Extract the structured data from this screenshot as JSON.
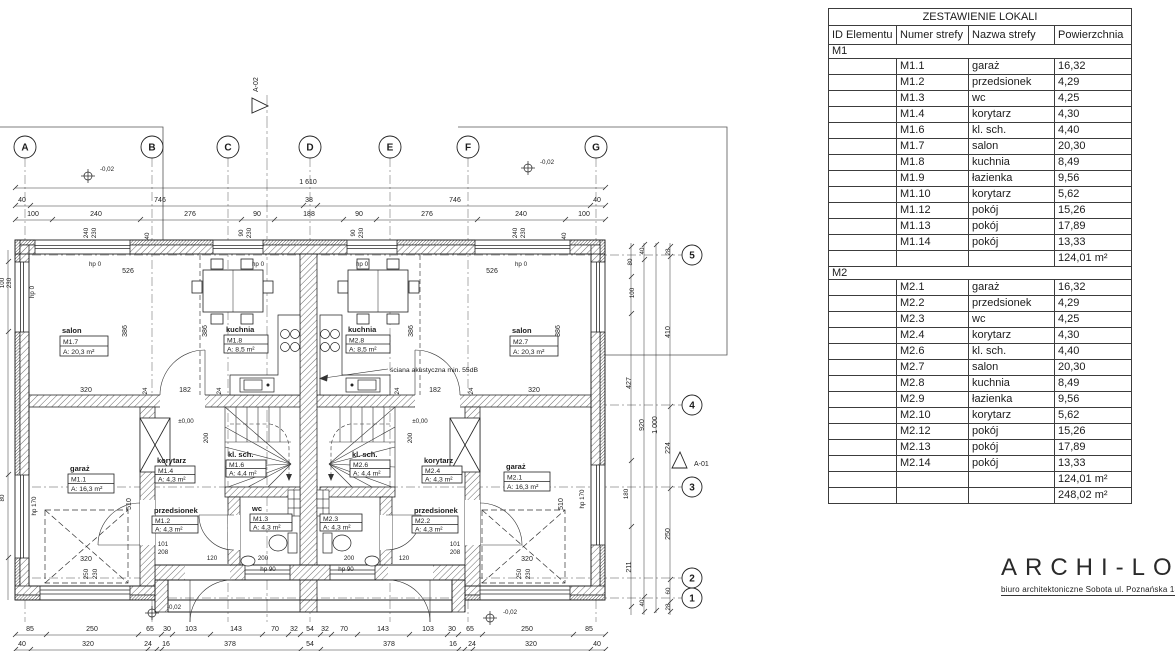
{
  "plan": {
    "grid_cols": [
      "A",
      "B",
      "C",
      "D",
      "E",
      "F",
      "G"
    ],
    "grid_rows": [
      "5",
      "4",
      "3",
      "2",
      "1"
    ],
    "section_markers": {
      "top": "A-02",
      "right": "A-01"
    },
    "rooms": {
      "m1_7": {
        "name": "salon",
        "id": "M1.7",
        "area": "A: 20,3 m²"
      },
      "m1_8": {
        "name": "kuchnia",
        "id": "M1.8",
        "area": "A: 8,5 m²"
      },
      "m2_8": {
        "name": "kuchnia",
        "id": "M2.8",
        "area": "A: 8,5 m²"
      },
      "m2_7": {
        "name": "salon",
        "id": "M2.7",
        "area": "A: 20,3 m²"
      },
      "m1_1": {
        "name": "garaż",
        "id": "M1.1",
        "area": "A: 16,3 m²"
      },
      "m1_4": {
        "name": "korytarz",
        "id": "M1.4",
        "area": "A: 4,3 m²"
      },
      "m1_6": {
        "name": "kl. sch.",
        "id": "M1.6",
        "area": "A: 4,4 m²"
      },
      "m1_2": {
        "name": "przedsionek",
        "id": "M1.2",
        "area": "A: 4,3 m²"
      },
      "m1_3": {
        "name": "wc",
        "id": "M1.3",
        "area": "A: 4,3 m²"
      },
      "m2_6": {
        "name": "kl. sch.",
        "id": "M2.6",
        "area": "A: 4,4 m²"
      },
      "m2_4": {
        "name": "korytarz",
        "id": "M2.4",
        "area": "A: 4,3 m²"
      },
      "m2_2": {
        "name": "przedsionek",
        "id": "M2.2",
        "area": "A: 4,3 m²"
      },
      "m2_3": {
        "name": "",
        "id": "M2.3",
        "area": "A: 4,3 m²"
      },
      "m2_1": {
        "name": "garaż",
        "id": "M2.1",
        "area": "A: 16,3 m²"
      }
    },
    "notes": {
      "acoustic": "ściana akustyczna min. 55dB"
    },
    "dim_labels": [
      {
        "t": "1 610",
        "x": 308,
        "y": 184
      },
      {
        "t": "40",
        "x": 22,
        "y": 202
      },
      {
        "t": "746",
        "x": 160,
        "y": 202
      },
      {
        "t": "38",
        "x": 309,
        "y": 202
      },
      {
        "t": "746",
        "x": 455,
        "y": 202
      },
      {
        "t": "40",
        "x": 597,
        "y": 202
      },
      {
        "t": "100",
        "x": 33,
        "y": 216
      },
      {
        "t": "240",
        "x": 96,
        "y": 216
      },
      {
        "t": "276",
        "x": 190,
        "y": 216
      },
      {
        "t": "90",
        "x": 257,
        "y": 216
      },
      {
        "t": "188",
        "x": 309,
        "y": 216
      },
      {
        "t": "90",
        "x": 359,
        "y": 216
      },
      {
        "t": "276",
        "x": 427,
        "y": 216
      },
      {
        "t": "240",
        "x": 521,
        "y": 216
      },
      {
        "t": "100",
        "x": 584,
        "y": 216
      },
      {
        "t": "240",
        "x": 88,
        "y": 233,
        "r": 1,
        "s": 1
      },
      {
        "t": "230",
        "x": 96,
        "y": 233,
        "r": 1,
        "s": 1
      },
      {
        "t": "40",
        "x": 149,
        "y": 236,
        "r": 1,
        "s": 1
      },
      {
        "t": "90",
        "x": 243,
        "y": 233,
        "r": 1,
        "s": 1
      },
      {
        "t": "230",
        "x": 251,
        "y": 233,
        "r": 1,
        "s": 1
      },
      {
        "t": "90",
        "x": 355,
        "y": 233,
        "r": 1,
        "s": 1
      },
      {
        "t": "230",
        "x": 363,
        "y": 233,
        "r": 1,
        "s": 1
      },
      {
        "t": "240",
        "x": 517,
        "y": 233,
        "r": 1,
        "s": 1
      },
      {
        "t": "230",
        "x": 525,
        "y": 233,
        "r": 1,
        "s": 1
      },
      {
        "t": "40",
        "x": 566,
        "y": 236,
        "r": 1,
        "s": 1
      },
      {
        "t": "-0,02",
        "x": 107,
        "y": 171,
        "s": 1
      },
      {
        "t": "-0,02",
        "x": 547,
        "y": 164,
        "s": 1
      },
      {
        "t": "hp 0",
        "x": 95,
        "y": 266,
        "s": 1
      },
      {
        "t": "hp 0",
        "x": 258,
        "y": 266,
        "s": 1
      },
      {
        "t": "hp 0",
        "x": 362,
        "y": 266,
        "s": 1
      },
      {
        "t": "hp 0",
        "x": 521,
        "y": 266,
        "s": 1
      },
      {
        "t": "526",
        "x": 128,
        "y": 273
      },
      {
        "t": "526",
        "x": 492,
        "y": 273
      },
      {
        "t": "386",
        "x": 127,
        "y": 331,
        "r": 1
      },
      {
        "t": "386",
        "x": 207,
        "y": 331,
        "r": 1
      },
      {
        "t": "386",
        "x": 413,
        "y": 331,
        "r": 1
      },
      {
        "t": "386",
        "x": 560,
        "y": 331,
        "r": 1
      },
      {
        "t": "320",
        "x": 86,
        "y": 392
      },
      {
        "t": "24",
        "x": 147,
        "y": 391,
        "r": 1,
        "s": 1
      },
      {
        "t": "182",
        "x": 185,
        "y": 392
      },
      {
        "t": "24",
        "x": 221,
        "y": 391,
        "r": 1,
        "s": 1
      },
      {
        "t": "24",
        "x": 399,
        "y": 391,
        "r": 1,
        "s": 1
      },
      {
        "t": "182",
        "x": 435,
        "y": 392
      },
      {
        "t": "24",
        "x": 473,
        "y": 391,
        "r": 1,
        "s": 1
      },
      {
        "t": "320",
        "x": 534,
        "y": 392
      },
      {
        "t": "±0,00",
        "x": 186,
        "y": 423,
        "s": 1
      },
      {
        "t": "±0,00",
        "x": 420,
        "y": 423,
        "s": 1
      },
      {
        "t": "200",
        "x": 208,
        "y": 438,
        "r": 1,
        "s": 1
      },
      {
        "t": "200",
        "x": 412,
        "y": 438,
        "r": 1,
        "s": 1
      },
      {
        "t": "510",
        "x": 131,
        "y": 504,
        "r": 1
      },
      {
        "t": "510",
        "x": 563,
        "y": 504,
        "r": 1
      },
      {
        "t": "hp 170",
        "x": 36,
        "y": 506,
        "r": 1,
        "s": 1
      },
      {
        "t": "hp 170",
        "x": 584,
        "y": 499,
        "r": 1,
        "s": 1
      },
      {
        "t": "100",
        "x": 4,
        "y": 283,
        "r": 1,
        "s": 1
      },
      {
        "t": "230",
        "x": 11,
        "y": 283,
        "r": 1,
        "s": 1
      },
      {
        "t": "hp 0",
        "x": 34,
        "y": 292,
        "r": 1,
        "s": 1
      },
      {
        "t": "80",
        "x": 4,
        "y": 498,
        "r": 1,
        "s": 1
      },
      {
        "t": "101",
        "x": 163,
        "y": 546,
        "s": 1
      },
      {
        "t": "208",
        "x": 163,
        "y": 554,
        "s": 1
      },
      {
        "t": "101",
        "x": 455,
        "y": 546,
        "s": 1
      },
      {
        "t": "208",
        "x": 455,
        "y": 554,
        "s": 1
      },
      {
        "t": "120",
        "x": 212,
        "y": 560,
        "s": 1
      },
      {
        "t": "200",
        "x": 263,
        "y": 560,
        "s": 1
      },
      {
        "t": "200",
        "x": 349,
        "y": 560,
        "s": 1
      },
      {
        "t": "120",
        "x": 404,
        "y": 560,
        "s": 1
      },
      {
        "t": "320",
        "x": 86,
        "y": 561
      },
      {
        "t": "320",
        "x": 527,
        "y": 561
      },
      {
        "t": "250",
        "x": 88,
        "y": 574,
        "r": 1,
        "s": 1
      },
      {
        "t": "230",
        "x": 97,
        "y": 574,
        "r": 1,
        "s": 1
      },
      {
        "t": "250",
        "x": 521,
        "y": 574,
        "r": 1,
        "s": 1
      },
      {
        "t": "230",
        "x": 530,
        "y": 574,
        "r": 1,
        "s": 1
      },
      {
        "t": "hp 90",
        "x": 268,
        "y": 571,
        "s": 1
      },
      {
        "t": "hp 90",
        "x": 346,
        "y": 571,
        "s": 1
      },
      {
        "t": "-0,02",
        "x": 174,
        "y": 609,
        "s": 1
      },
      {
        "t": "-0,02",
        "x": 510,
        "y": 614,
        "s": 1
      },
      {
        "t": "80",
        "x": 632,
        "y": 262,
        "r": 1,
        "s": 1
      },
      {
        "t": "100",
        "x": 634,
        "y": 293,
        "r": 1,
        "s": 1
      },
      {
        "t": "427",
        "x": 631,
        "y": 383,
        "r": 1
      },
      {
        "t": "180",
        "x": 628,
        "y": 494,
        "r": 1,
        "s": 1
      },
      {
        "t": "211",
        "x": 631,
        "y": 567,
        "r": 1
      },
      {
        "t": "40",
        "x": 644,
        "y": 251,
        "r": 1,
        "s": 1
      },
      {
        "t": "920",
        "x": 644,
        "y": 425,
        "r": 1
      },
      {
        "t": "40",
        "x": 644,
        "y": 603,
        "r": 1,
        "s": 1
      },
      {
        "t": "1 000",
        "x": 657,
        "y": 425,
        "r": 1
      },
      {
        "t": "28",
        "x": 670,
        "y": 252,
        "r": 1,
        "s": 1
      },
      {
        "t": "410",
        "x": 670,
        "y": 332,
        "r": 1
      },
      {
        "t": "224",
        "x": 670,
        "y": 448,
        "r": 1
      },
      {
        "t": "250",
        "x": 670,
        "y": 534,
        "r": 1
      },
      {
        "t": "60",
        "x": 670,
        "y": 591,
        "r": 1,
        "s": 1
      },
      {
        "t": "28",
        "x": 670,
        "y": 607,
        "r": 1,
        "s": 1
      },
      {
        "t": "85",
        "x": 30,
        "y": 631
      },
      {
        "t": "250",
        "x": 92,
        "y": 631
      },
      {
        "t": "65",
        "x": 150,
        "y": 631
      },
      {
        "t": "30",
        "x": 167,
        "y": 631
      },
      {
        "t": "103",
        "x": 191,
        "y": 631
      },
      {
        "t": "143",
        "x": 236,
        "y": 631
      },
      {
        "t": "70",
        "x": 275,
        "y": 631
      },
      {
        "t": "32",
        "x": 294,
        "y": 631
      },
      {
        "t": "54",
        "x": 310,
        "y": 631
      },
      {
        "t": "32",
        "x": 325,
        "y": 631
      },
      {
        "t": "70",
        "x": 344,
        "y": 631
      },
      {
        "t": "143",
        "x": 383,
        "y": 631
      },
      {
        "t": "103",
        "x": 428,
        "y": 631
      },
      {
        "t": "30",
        "x": 452,
        "y": 631
      },
      {
        "t": "65",
        "x": 470,
        "y": 631
      },
      {
        "t": "250",
        "x": 527,
        "y": 631
      },
      {
        "t": "85",
        "x": 589,
        "y": 631
      },
      {
        "t": "40",
        "x": 22,
        "y": 646
      },
      {
        "t": "320",
        "x": 88,
        "y": 646
      },
      {
        "t": "24",
        "x": 148,
        "y": 646
      },
      {
        "t": "16",
        "x": 166,
        "y": 646
      },
      {
        "t": "378",
        "x": 230,
        "y": 646
      },
      {
        "t": "54",
        "x": 310,
        "y": 646
      },
      {
        "t": "378",
        "x": 389,
        "y": 646
      },
      {
        "t": "16",
        "x": 453,
        "y": 646
      },
      {
        "t": "24",
        "x": 472,
        "y": 646
      },
      {
        "t": "320",
        "x": 531,
        "y": 646
      },
      {
        "t": "40",
        "x": 597,
        "y": 646
      }
    ]
  },
  "table": {
    "title": "ZESTAWIENIE LOKALI",
    "columns": [
      "ID Elementu",
      "Numer strefy",
      "Nazwa strefy",
      "Powierzchnia"
    ],
    "m1": {
      "label": "M1",
      "rows": [
        [
          "M1.1",
          "garaż",
          "16,32"
        ],
        [
          "M1.2",
          "przedsionek",
          "4,29"
        ],
        [
          "M1.3",
          "wc",
          "4,25"
        ],
        [
          "M1.4",
          "korytarz",
          "4,30"
        ],
        [
          "M1.6",
          "kl. sch.",
          "4,40"
        ],
        [
          "M1.7",
          "salon",
          "20,30"
        ],
        [
          "M1.8",
          "kuchnia",
          "8,49"
        ],
        [
          "M1.9",
          "łazienka",
          "9,56"
        ],
        [
          "M1.10",
          "korytarz",
          "5,62"
        ],
        [
          "M1.12",
          "pokój",
          "15,26"
        ],
        [
          "M1.13",
          "pokój",
          "17,89"
        ],
        [
          "M1.14",
          "pokój",
          "13,33"
        ]
      ],
      "subtotal": "124,01 m²"
    },
    "m2": {
      "label": "M2",
      "rows": [
        [
          "M2.1",
          "garaż",
          "16,32"
        ],
        [
          "M2.2",
          "przedsionek",
          "4,29"
        ],
        [
          "M2.3",
          "wc",
          "4,25"
        ],
        [
          "M2.4",
          "korytarz",
          "4,30"
        ],
        [
          "M2.6",
          "kl. sch.",
          "4,40"
        ],
        [
          "M2.7",
          "salon",
          "20,30"
        ],
        [
          "M2.8",
          "kuchnia",
          "8,49"
        ],
        [
          "M2.9",
          "łazienka",
          "9,56"
        ],
        [
          "M2.10",
          "korytarz",
          "5,62"
        ],
        [
          "M2.12",
          "pokój",
          "15,26"
        ],
        [
          "M2.13",
          "pokój",
          "17,89"
        ],
        [
          "M2.14",
          "pokój",
          "13,33"
        ]
      ],
      "subtotal": "124,01 m²"
    },
    "total": "248,02 m²"
  },
  "logo": {
    "name": "ARCHI-LOG",
    "address": "biuro architektoniczne  Sobota ul. Poznańska 13/1 62-0"
  }
}
